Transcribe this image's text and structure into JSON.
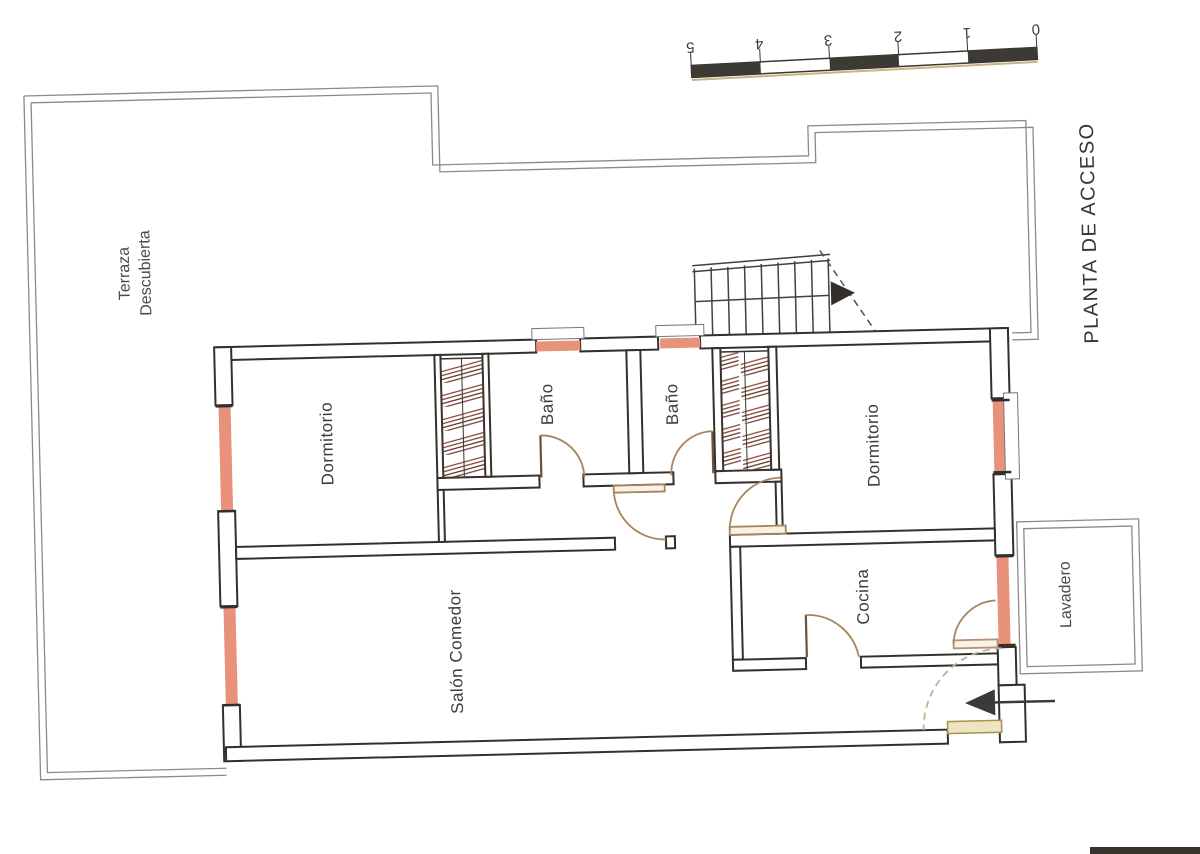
{
  "document": {
    "title": "PLANTA DE ACCESO"
  },
  "rooms": {
    "terraza_line1": "Terraza",
    "terraza_line2": "Descubierta",
    "dormitorio_left": "Dormitorio",
    "bano_left": "Baño",
    "bano_right": "Baño",
    "dormitorio_right": "Dormitorio",
    "salon_comedor": "Salón Comedor",
    "cocina": "Cocina",
    "lavadero": "Lavadero"
  },
  "scale_bar": {
    "numbers": [
      "0",
      "1",
      "2",
      "3",
      "4",
      "5"
    ]
  },
  "colors": {
    "wall": "#32302c",
    "terrace_line": "#8a8a8a",
    "window_fill": "#e8927b",
    "door_arc": "#a8845e",
    "closet_hatch": "#7b4233",
    "threshold": "#efe3c2",
    "label_text": "#3f3f3f"
  }
}
